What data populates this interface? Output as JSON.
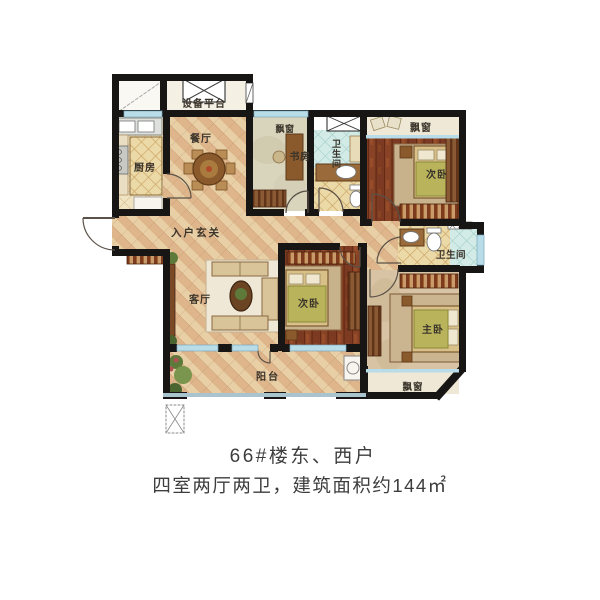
{
  "caption": {
    "line1": "66#楼东、西户",
    "line2": "四室两厅两卫，建筑面积约144㎡"
  },
  "rooms": {
    "equipment_platform": "设备平台",
    "dining": "餐厅",
    "kitchen": "厨房",
    "bay_window_study": "飘窗",
    "study": "书房",
    "bathroom_center": "卫生间",
    "bay_window_top": "飘窗",
    "bedroom_top": "次卧",
    "bathroom_right": "卫生间",
    "master_bedroom": "主卧",
    "bay_window_master": "飘窗",
    "bedroom_middle": "次卧",
    "living_room": "客厅",
    "entry_hall": "入户玄关",
    "balcony": "阳台"
  },
  "colors": {
    "wall": "#181614",
    "floor_lattice": "#e9cfa6",
    "wood_floor": "#7b3a21",
    "tile_blue": "#d2ebe7",
    "window": "#b8dce8",
    "caption_text": "#3d3d3d"
  }
}
